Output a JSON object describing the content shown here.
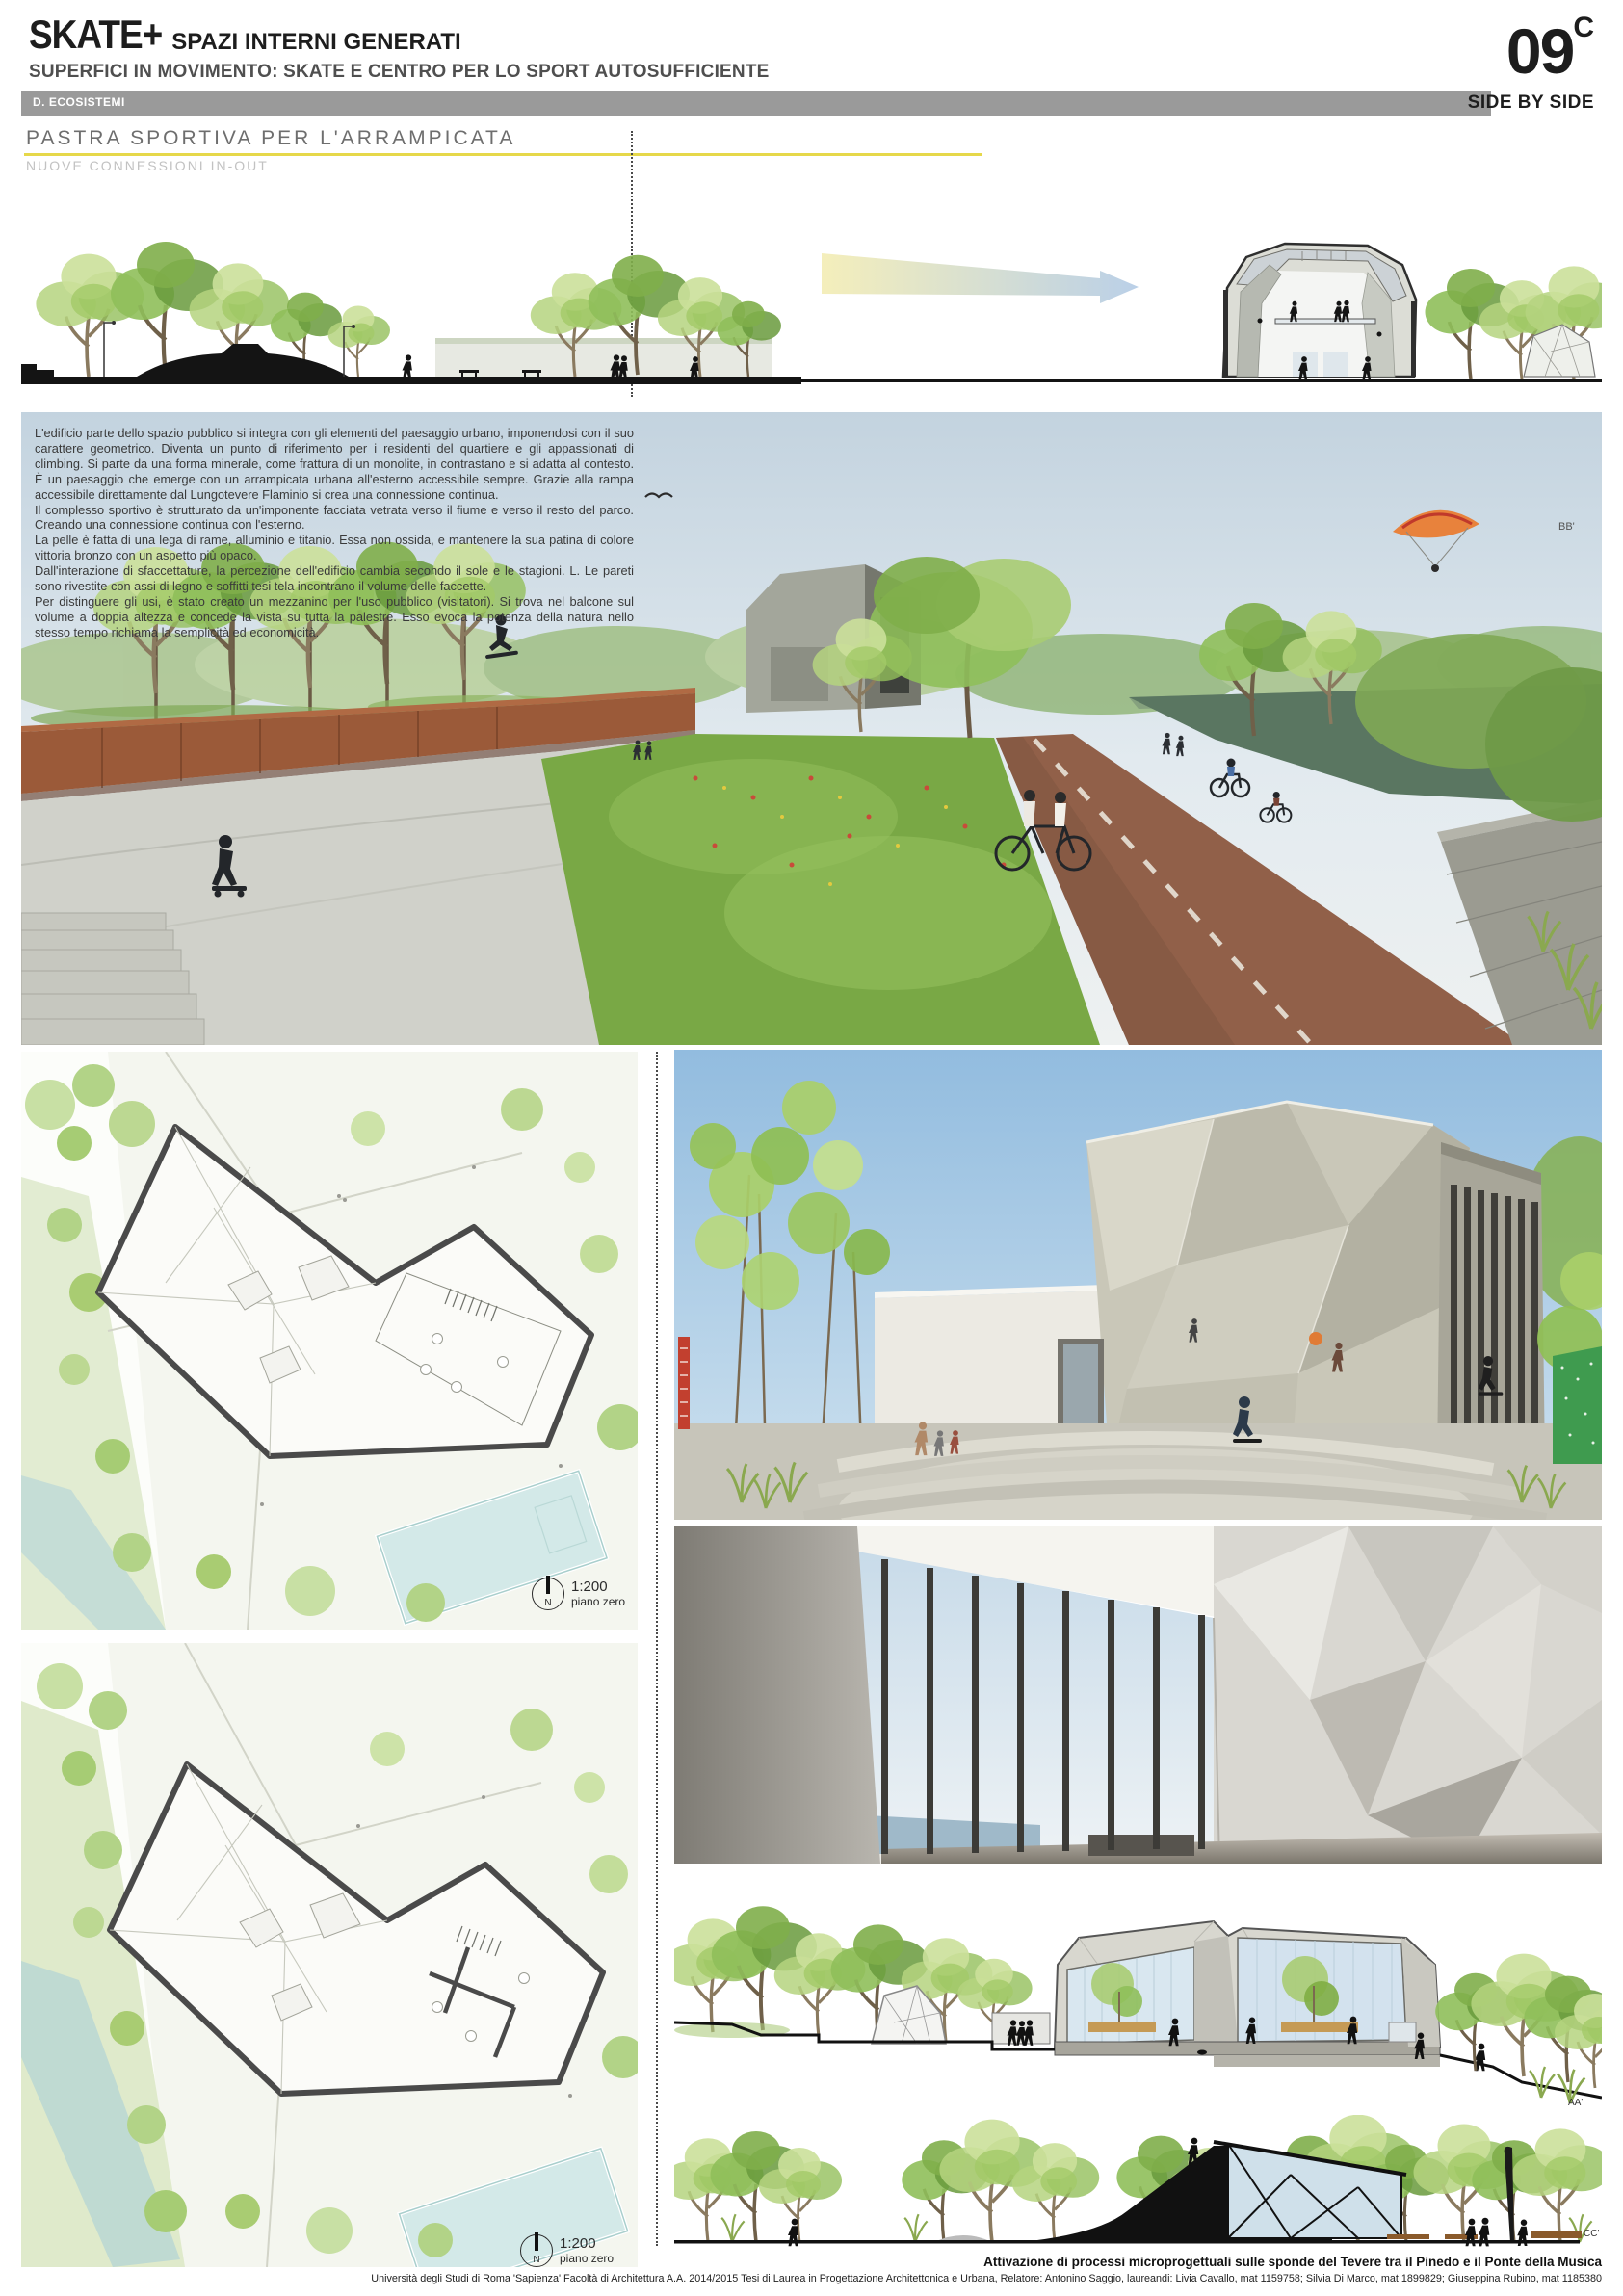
{
  "header": {
    "title": "SKATE+",
    "title_suffix": "SPAZI INTERNI GENERATI",
    "subtitle": "SUPERFICI IN MOVIMENTO: SKATE E CENTRO PER LO SPORT AUTOSUFFICIENTE",
    "category": "D. ECOSISTEMI",
    "board_number": "09",
    "board_letter": "C",
    "series": "SIDE BY SIDE"
  },
  "section_header": {
    "title": "PASTRA SPORTIVA PER L'ARRAMPICATA",
    "subtitle": "NUOVE CONNESSIONI IN-OUT"
  },
  "description": {
    "paragraphs": [
      "L'edificio parte dello spazio pubblico si integra con gli elementi del paesaggio urbano, imponendosi con il suo carattere geometrico. Diventa un punto di riferimento per i residenti del quartiere e gli appassionati di climbing. Si parte da una forma minerale, come frattura di un monolite, in contrastano e si adatta al contesto. È un paesaggio che emerge con un arrampicata urbana all'esterno accessibile sempre. Grazie alla rampa accessibile direttamente dal Lungotevere Flaminio si crea una connessione continua.",
      "Il complesso sportivo è strutturato da un'imponente facciata vetrata verso il fiume e verso il resto del parco. Creando una connessione continua con l'esterno.",
      "La pelle è fatta di una lega di rame, alluminio e titanio. Essa non ossida, e mantenere la sua patina di colore vittoria bronzo con un aspetto più opaco.",
      "Dall'interazione di sfaccettature, la percezione dell'edificio cambia secondo il sole e le stagioni. L. Le pareti sono rivestite con assi di legno e soffitti tesi tela incontrano il volume delle faccette.",
      "Per distinguere gli usi, è stato creato un mezzanino per l'uso pubblico (visitatori). Si trova nel balcone sul volume a doppia altezza e concede la vista su tutta la palestre. Esso evoca la potenza della natura nello stesso tempo richiama la semplicità ed economicità."
    ]
  },
  "plan_labels": [
    {
      "scale": "1:200",
      "level": "piano zero",
      "north": "N"
    },
    {
      "scale": "1:200",
      "level": "piano zero",
      "north": "N"
    }
  ],
  "section_labels": {
    "bb": "BB'",
    "aa": "AA'",
    "cc": "CC'"
  },
  "footer": {
    "project": "Attivazione di processi microprogettuali sulle sponde del Tevere tra il Pinedo e il Ponte della Musica",
    "credits": "Università degli Studi di Roma 'Sapienza'   Facoltà di Architettura   A.A. 2014/2015   Tesi di Laurea in Progettazione Architettonica e Urbana, Relatore: Antonino Saggio, laureandi: Livia Cavallo, mat 1159758; Silvia Di Marco, mat 1899829; Giuseppina Rubino, mat 1185380"
  },
  "colors": {
    "accent_underline": "#e6d84a",
    "category_bar": "#9a9a9a",
    "corten": "#9b5a39",
    "grass": "#7fae4a",
    "sky": "#c9d6e0",
    "louver_dark": "#403f3a"
  }
}
